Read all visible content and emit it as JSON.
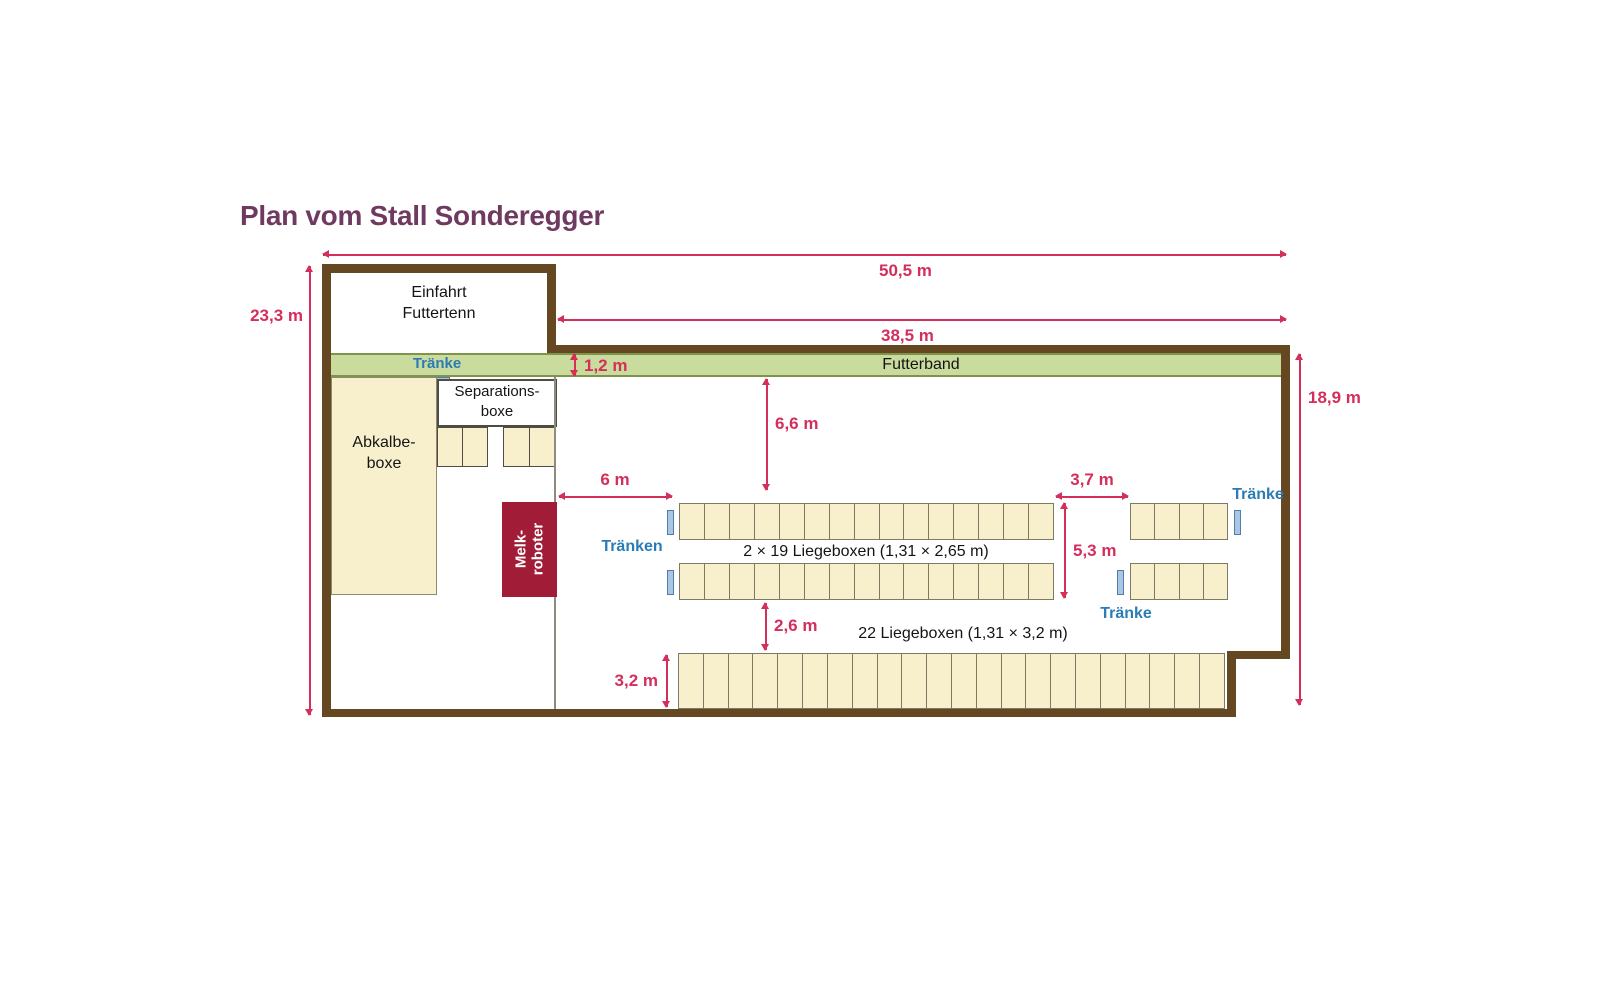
{
  "title": "Plan vom Stall Sonderegger",
  "colors": {
    "wall": "#654722",
    "band": "#cadb9e",
    "bandBorder": "#7f934c",
    "cream": "#f8f0cd",
    "creamBorder": "#8f8a6d",
    "cellBorder": "#7d7a64",
    "roomBorder": "#4d4d44",
    "innerWall": "#8c8c80",
    "melk": "#a11d37",
    "dim": "#d42e5b",
    "blue": "#2b7cb5",
    "troughFill": "#a9c6e4",
    "troughBorder": "#527ea6",
    "title": "#6f3a60",
    "text": "#141414"
  },
  "rooms": {
    "einfahrt": {
      "line1": "Einfahrt",
      "line2": "Futtertenn"
    },
    "abkalbe": {
      "line1": "Abkalbe-",
      "line2": "boxe"
    },
    "separation": {
      "line1": "Separations-",
      "line2": "boxe"
    },
    "melkroboter": {
      "line1": "Melk-",
      "line2": "roboter"
    },
    "futterband": {
      "label": "Futterband"
    }
  },
  "dimensions": {
    "total_width": "50,5 m",
    "hall_width": "38,5 m",
    "left_height": "23,3 m",
    "right_height": "18,9 m",
    "band_height": "1,2 m",
    "feed_alley_depth": "6,6 m",
    "left_gap": "6 m",
    "right_gap": "3,7 m",
    "row_gap": "5,3 m",
    "lower_gap": "2,6 m",
    "bottom_box_depth": "3,2 m"
  },
  "labels": {
    "traenke": "Tränke",
    "traenken": "Tränken",
    "upper_rows": "2 × 19 Liegeboxen (1,31 × 2,65 m)",
    "bottom_row": "22 Liegeboxen (1,31 × 3,2 m)"
  },
  "boxes": {
    "upper_left_cells": 15,
    "upper_right_cells": 4,
    "bottom_cells": 22,
    "separation_group_cells": 2
  }
}
